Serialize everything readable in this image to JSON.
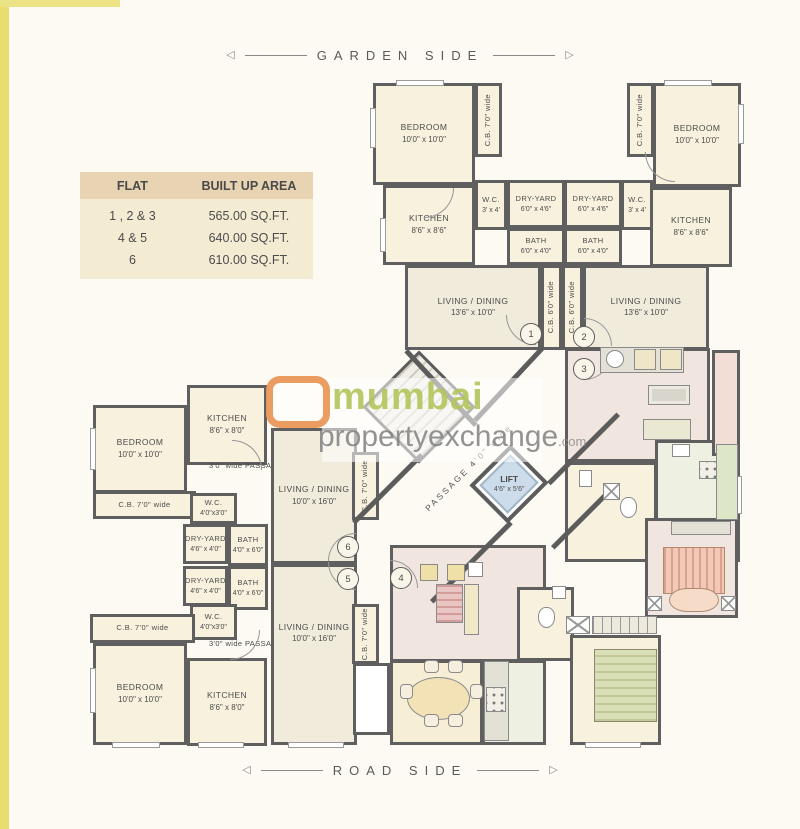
{
  "page": {
    "garden_side": "GARDEN SIDE",
    "road_side": "ROAD SIDE",
    "arrow_left": "◁",
    "arrow_right": "▷"
  },
  "table": {
    "headers": [
      "FLAT",
      "BUILT UP AREA"
    ],
    "rows": [
      {
        "flat": "1 , 2 & 3",
        "area": "565.00 SQ.FT."
      },
      {
        "flat": "4 & 5",
        "area": "640.00 SQ.FT."
      },
      {
        "flat": "6",
        "area": "610.00 SQ.FT."
      }
    ]
  },
  "watermark": {
    "word1": "mumbai",
    "word2": "propertyexchange",
    "suffix": ".com"
  },
  "colors": {
    "c": "#f7f1de",
    "l": "#f1ebdb",
    "p": "#f0e6df",
    "y": "#f6efd6",
    "k": "#eef0e2",
    "b": "#f3ded6",
    "w": "#ffffff",
    "wall": "#5c5c5c",
    "accent_green": "#b2c65c",
    "accent_orange": "#e88c46",
    "table_header": "#e8d3b2",
    "table_body": "#f4ebd3",
    "lift_blue": "#cddcea"
  },
  "plan": {
    "lift": {
      "label": "LIFT",
      "dims": "4'6\" x 5'6\""
    },
    "passage": {
      "label": "PASSAGE 4'0\" wide"
    },
    "rooms": [
      {
        "id": "bedroom-1",
        "label": "BEDROOM",
        "dims": "10'0\" x 10'0\"",
        "x": 373,
        "y": 83,
        "w": 102,
        "h": 102,
        "f": "c"
      },
      {
        "id": "cb-balcony-1",
        "label": "C.B. 7'0\" wide",
        "x": 475,
        "y": 83,
        "w": 27,
        "h": 74,
        "f": "c",
        "v": 1
      },
      {
        "id": "kitchen-1",
        "label": "KITCHEN",
        "dims": "8'6\" x 8'6\"",
        "x": 383,
        "y": 185,
        "w": 92,
        "h": 80,
        "f": "c"
      },
      {
        "id": "wc-1",
        "label": "W.C.",
        "dims": "3' x 4'",
        "x": 475,
        "y": 180,
        "w": 32,
        "h": 50,
        "f": "c",
        "sm": 1
      },
      {
        "id": "dry-yard-1",
        "label": "DRY-YARD",
        "dims": "6'0\" x 4'6\"",
        "x": 507,
        "y": 180,
        "w": 58,
        "h": 48,
        "f": "c",
        "sm": 1
      },
      {
        "id": "bath-1",
        "label": "BATH",
        "dims": "6'0\" x 4'0\"",
        "x": 507,
        "y": 228,
        "w": 58,
        "h": 37,
        "f": "c",
        "sm": 1
      },
      {
        "id": "dry-yard-2",
        "label": "DRY-YARD",
        "dims": "6'0\" x 4'6\"",
        "x": 564,
        "y": 180,
        "w": 58,
        "h": 48,
        "f": "c",
        "sm": 1
      },
      {
        "id": "bath-2",
        "label": "BATH",
        "dims": "6'0\" x 4'0\"",
        "x": 564,
        "y": 228,
        "w": 58,
        "h": 37,
        "f": "c",
        "sm": 1
      },
      {
        "id": "wc-2",
        "label": "W.C.",
        "dims": "3' x 4'",
        "x": 621,
        "y": 180,
        "w": 32,
        "h": 50,
        "f": "c",
        "sm": 1
      },
      {
        "id": "cb-balcony-2",
        "label": "C.B. 7'0\" wide",
        "x": 627,
        "y": 83,
        "w": 27,
        "h": 74,
        "f": "c",
        "v": 1
      },
      {
        "id": "bedroom-2",
        "label": "BEDROOM",
        "dims": "10'0\" x 10'0\"",
        "x": 653,
        "y": 83,
        "w": 88,
        "h": 104,
        "f": "c"
      },
      {
        "id": "kitchen-2",
        "label": "KITCHEN",
        "dims": "8'6\" x 8'6\"",
        "x": 650,
        "y": 187,
        "w": 82,
        "h": 80,
        "f": "c"
      },
      {
        "id": "living-1",
        "label": "LIVING / DINING",
        "dims": "13'6\" x 10'0\"",
        "x": 405,
        "y": 265,
        "w": 136,
        "h": 85,
        "f": "l"
      },
      {
        "id": "cb-balcony-3",
        "label": "C.B. 6'0\" wide",
        "x": 541,
        "y": 265,
        "w": 21,
        "h": 85,
        "f": "c",
        "v": 1,
        "sm": 1
      },
      {
        "id": "cb-balcony-4",
        "label": "C.B. 6'0\" wide",
        "x": 562,
        "y": 265,
        "w": 21,
        "h": 85,
        "f": "c",
        "v": 1,
        "sm": 1
      },
      {
        "id": "living-2",
        "label": "LIVING / DINING",
        "dims": "13'6\" x 10'0\"",
        "x": 583,
        "y": 265,
        "w": 126,
        "h": 85,
        "f": "l"
      },
      {
        "id": "bedroom-6",
        "label": "BEDROOM",
        "dims": "10'0\" x 10'0\"",
        "x": 93,
        "y": 405,
        "w": 94,
        "h": 88,
        "f": "c"
      },
      {
        "id": "cb-balcony-6a",
        "label": "C.B. 7'0\" wide",
        "x": 93,
        "y": 491,
        "w": 103,
        "h": 28,
        "f": "c",
        "sm": 1
      },
      {
        "id": "kitchen-6",
        "label": "KITCHEN",
        "dims": "8'6\" x 8'0\"",
        "x": 187,
        "y": 385,
        "w": 80,
        "h": 80,
        "f": "c"
      },
      {
        "id": "passage-6",
        "label": "3'0\" wide PASSAGE",
        "x": 190,
        "y": 455,
        "w": 112,
        "h": 22,
        "nb": 1,
        "sm": 1
      },
      {
        "id": "wc-6",
        "label": "W.C.",
        "dims": "4'0\"x3'0\"",
        "x": 190,
        "y": 493,
        "w": 47,
        "h": 31,
        "f": "c",
        "sm": 1
      },
      {
        "id": "dry-yard-6",
        "label": "DRY-YARD",
        "dims": "4'6\" x 4'0\"",
        "x": 183,
        "y": 524,
        "w": 45,
        "h": 40,
        "f": "c",
        "sm": 1
      },
      {
        "id": "bath-6",
        "label": "BATH",
        "dims": "4'0\" x 6'0\"",
        "x": 228,
        "y": 524,
        "w": 40,
        "h": 42,
        "f": "c",
        "sm": 1
      },
      {
        "id": "living-6",
        "label": "LIVING / DINING",
        "dims": "10'0\" x 16'0\"",
        "x": 271,
        "y": 428,
        "w": 86,
        "h": 136,
        "f": "l"
      },
      {
        "id": "cb-balcony-6b",
        "label": "C.B. 7'0\" wide",
        "x": 352,
        "y": 452,
        "w": 27,
        "h": 68,
        "f": "c",
        "v": 1,
        "sm": 1
      },
      {
        "id": "dry-yard-5",
        "label": "DRY-YARD",
        "dims": "4'6\" x 4'0\"",
        "x": 183,
        "y": 566,
        "w": 45,
        "h": 40,
        "f": "c",
        "sm": 1
      },
      {
        "id": "bath-5",
        "label": "BATH",
        "dims": "4'0\" x 6'0\"",
        "x": 228,
        "y": 566,
        "w": 40,
        "h": 44,
        "f": "c",
        "sm": 1
      },
      {
        "id": "wc-5",
        "label": "W.C.",
        "dims": "4'0\"x3'0\"",
        "x": 190,
        "y": 604,
        "w": 47,
        "h": 36,
        "f": "c",
        "sm": 1
      },
      {
        "id": "cb-balcony-5a",
        "label": "C.B. 7'0\" wide",
        "x": 90,
        "y": 614,
        "w": 105,
        "h": 29,
        "f": "c",
        "sm": 1
      },
      {
        "id": "bedroom-5",
        "label": "BEDROOM",
        "dims": "10'0\" x 10'0\"",
        "x": 93,
        "y": 643,
        "w": 94,
        "h": 102,
        "f": "c"
      },
      {
        "id": "passage-5",
        "label": "3'0\" wide PASSAGE",
        "x": 190,
        "y": 634,
        "w": 112,
        "h": 20,
        "nb": 1,
        "sm": 1
      },
      {
        "id": "kitchen-5",
        "label": "KITCHEN",
        "dims": "8'6\" x 8'0\"",
        "x": 187,
        "y": 658,
        "w": 80,
        "h": 88,
        "f": "c"
      },
      {
        "id": "living-5",
        "label": "LIVING / DINING",
        "dims": "10'0\" x 16'0\"",
        "x": 271,
        "y": 564,
        "w": 86,
        "h": 181,
        "f": "l",
        "lt": 1
      },
      {
        "id": "cb-balcony-5b",
        "label": "C.B. 7'0\" wide",
        "x": 352,
        "y": 604,
        "w": 27,
        "h": 60,
        "f": "c",
        "v": 1,
        "sm": 1
      },
      {
        "id": "duct-1",
        "x": 353,
        "y": 663,
        "w": 37,
        "h": 72,
        "f": "w"
      },
      {
        "id": "flat4-living",
        "x": 390,
        "y": 545,
        "w": 156,
        "h": 117,
        "f": "p"
      },
      {
        "id": "flat4-dining",
        "x": 390,
        "y": 660,
        "w": 93,
        "h": 85,
        "f": "y"
      },
      {
        "id": "flat4-kitchen",
        "x": 482,
        "y": 660,
        "w": 64,
        "h": 85,
        "f": "k"
      },
      {
        "id": "flat4-bath",
        "x": 517,
        "y": 587,
        "w": 57,
        "h": 74,
        "f": "c"
      },
      {
        "id": "flat3-living",
        "x": 565,
        "y": 348,
        "w": 145,
        "h": 114,
        "f": "p"
      },
      {
        "id": "flat3-kitchen",
        "x": 655,
        "y": 440,
        "w": 85,
        "h": 122,
        "f": "k"
      },
      {
        "id": "flat3-bath",
        "x": 565,
        "y": 462,
        "w": 92,
        "h": 100,
        "f": "c"
      },
      {
        "id": "bedroom-right",
        "x": 645,
        "y": 518,
        "w": 93,
        "h": 100,
        "f": "p"
      },
      {
        "id": "bedroom-bottom",
        "x": 570,
        "y": 635,
        "w": 91,
        "h": 110,
        "f": "c"
      },
      {
        "id": "balcony-right",
        "x": 712,
        "y": 350,
        "w": 28,
        "h": 106,
        "f": "b"
      }
    ],
    "walls": [
      [
        408,
        349,
        102,
        47
      ],
      [
        545,
        349,
        100,
        133
      ],
      [
        352,
        521,
        96,
        -45
      ],
      [
        430,
        600,
        112,
        -45
      ],
      [
        620,
        416,
        98,
        135
      ],
      [
        551,
        546,
        76,
        -45
      ]
    ],
    "numbers": [
      {
        "n": "1",
        "x": 530,
        "y": 333
      },
      {
        "n": "2",
        "x": 583,
        "y": 336
      },
      {
        "n": "3",
        "x": 583,
        "y": 368
      },
      {
        "n": "4",
        "x": 400,
        "y": 577
      },
      {
        "n": "5",
        "x": 347,
        "y": 578
      },
      {
        "n": "6",
        "x": 347,
        "y": 546
      }
    ],
    "doors": [
      [
        506,
        315,
        30,
        "bl"
      ],
      [
        584,
        318,
        28,
        "tr"
      ],
      [
        584,
        352,
        28,
        "br"
      ],
      [
        390,
        560,
        28,
        "tr"
      ],
      [
        328,
        533,
        28,
        "tl"
      ],
      [
        328,
        562,
        28,
        "bl"
      ],
      [
        424,
        188,
        30,
        "br"
      ],
      [
        232,
        440,
        30,
        "tr"
      ],
      [
        230,
        630,
        30,
        "br"
      ],
      [
        645,
        152,
        30,
        "bl"
      ]
    ],
    "furniture": [
      {
        "t": "counter",
        "x": 600,
        "y": 347,
        "w": 84,
        "h": 26
      },
      {
        "t": "circle",
        "x": 606,
        "y": 350,
        "w": 18,
        "h": 18
      },
      {
        "t": "boxbeige",
        "x": 634,
        "y": 349,
        "w": 22,
        "h": 21
      },
      {
        "t": "boxbeige",
        "x": 660,
        "y": 349,
        "w": 22,
        "h": 21
      },
      {
        "t": "tv",
        "x": 648,
        "y": 385,
        "w": 42,
        "h": 20
      },
      {
        "t": "sofa",
        "x": 643,
        "y": 419,
        "w": 48,
        "h": 21
      },
      {
        "t": "counterg",
        "x": 716,
        "y": 444,
        "w": 22,
        "h": 76
      },
      {
        "t": "stove",
        "x": 699,
        "y": 461,
        "w": 18,
        "h": 18
      },
      {
        "t": "boxwhite",
        "x": 672,
        "y": 444,
        "w": 18,
        "h": 13
      },
      {
        "t": "toilet",
        "x": 620,
        "y": 497,
        "w": 17,
        "h": 21
      },
      {
        "t": "boxwhite",
        "x": 579,
        "y": 470,
        "w": 13,
        "h": 17
      },
      {
        "t": "xbox",
        "x": 603,
        "y": 483,
        "w": 17,
        "h": 17
      },
      {
        "t": "counter",
        "x": 671,
        "y": 521,
        "w": 60,
        "h": 14
      },
      {
        "t": "bedpink",
        "x": 663,
        "y": 547,
        "w": 62,
        "h": 47
      },
      {
        "t": "bedfoot",
        "x": 669,
        "y": 588,
        "w": 50,
        "h": 24
      },
      {
        "t": "xbox",
        "x": 647,
        "y": 596,
        "w": 15,
        "h": 15
      },
      {
        "t": "xbox",
        "x": 721,
        "y": 596,
        "w": 15,
        "h": 15
      },
      {
        "t": "wardrobe",
        "x": 592,
        "y": 616,
        "w": 65,
        "h": 18
      },
      {
        "t": "xbox",
        "x": 566,
        "y": 616,
        "w": 24,
        "h": 18
      },
      {
        "t": "bedgreen",
        "x": 594,
        "y": 649,
        "w": 63,
        "h": 73
      },
      {
        "t": "chairy",
        "x": 420,
        "y": 564,
        "w": 18,
        "h": 17
      },
      {
        "t": "chairy",
        "x": 447,
        "y": 564,
        "w": 18,
        "h": 17
      },
      {
        "t": "boxwhite",
        "x": 468,
        "y": 562,
        "w": 15,
        "h": 15
      },
      {
        "t": "sofapink",
        "x": 436,
        "y": 584,
        "w": 27,
        "h": 39
      },
      {
        "t": "cab",
        "x": 464,
        "y": 584,
        "w": 15,
        "h": 51
      },
      {
        "t": "dtable",
        "x": 407,
        "y": 677,
        "w": 63,
        "h": 43
      },
      {
        "t": "chair",
        "x": 424,
        "y": 660,
        "w": 15,
        "h": 13
      },
      {
        "t": "chair",
        "x": 448,
        "y": 660,
        "w": 15,
        "h": 13
      },
      {
        "t": "chair",
        "x": 400,
        "y": 684,
        "w": 13,
        "h": 15
      },
      {
        "t": "chair",
        "x": 470,
        "y": 684,
        "w": 13,
        "h": 15
      },
      {
        "t": "chair",
        "x": 424,
        "y": 714,
        "w": 15,
        "h": 13
      },
      {
        "t": "chair",
        "x": 448,
        "y": 714,
        "w": 15,
        "h": 13
      },
      {
        "t": "counter",
        "x": 484,
        "y": 661,
        "w": 25,
        "h": 80
      },
      {
        "t": "stove",
        "x": 486,
        "y": 687,
        "w": 20,
        "h": 25
      },
      {
        "t": "toilet",
        "x": 538,
        "y": 607,
        "w": 17,
        "h": 21
      },
      {
        "t": "boxwhite",
        "x": 552,
        "y": 586,
        "w": 14,
        "h": 13
      }
    ],
    "windows": [
      [
        370,
        108,
        6,
        40
      ],
      [
        396,
        80,
        48,
        6
      ],
      [
        664,
        80,
        48,
        6
      ],
      [
        738,
        104,
        6,
        40
      ],
      [
        90,
        428,
        6,
        42
      ],
      [
        90,
        668,
        6,
        45
      ],
      [
        112,
        742,
        48,
        6
      ],
      [
        198,
        742,
        46,
        6
      ],
      [
        288,
        742,
        56,
        6
      ],
      [
        380,
        218,
        6,
        34
      ],
      [
        585,
        742,
        56,
        6
      ],
      [
        736,
        476,
        6,
        38
      ]
    ]
  }
}
